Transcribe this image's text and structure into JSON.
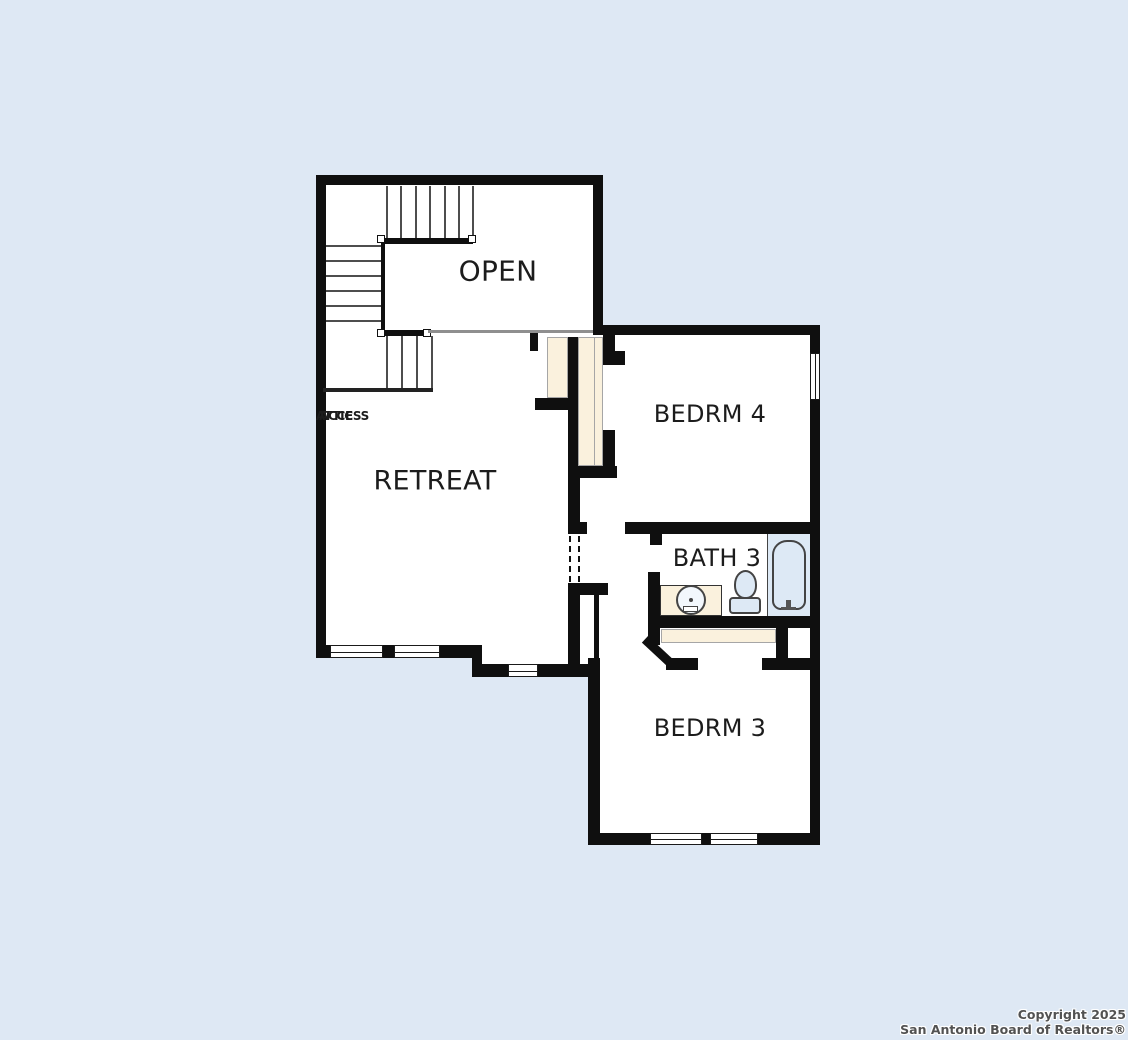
{
  "rooms": {
    "open": {
      "label": "OPEN"
    },
    "retreat": {
      "label": "RETREAT"
    },
    "bedrm4": {
      "label": "BEDRM 4"
    },
    "bath3": {
      "label": "BATH 3"
    },
    "bedrm3": {
      "label": "BEDRM 3"
    },
    "attic": {
      "line1": "ATTIC",
      "line2": "ACCESS"
    }
  },
  "footer": {
    "line1": "Copyright 2025",
    "line2": "San Antonio Board of Realtors®"
  },
  "colors": {
    "background": "#dee8f4",
    "floor": "#ffffff",
    "wall": "#0f0f0f",
    "door_fill": "#faf1dd",
    "fixture_fill": "#dde9f5",
    "tread": "#4d4d4d",
    "open_edge": "#8f8f8f",
    "label": "#1c1c1c",
    "footer_text": "#525252"
  }
}
